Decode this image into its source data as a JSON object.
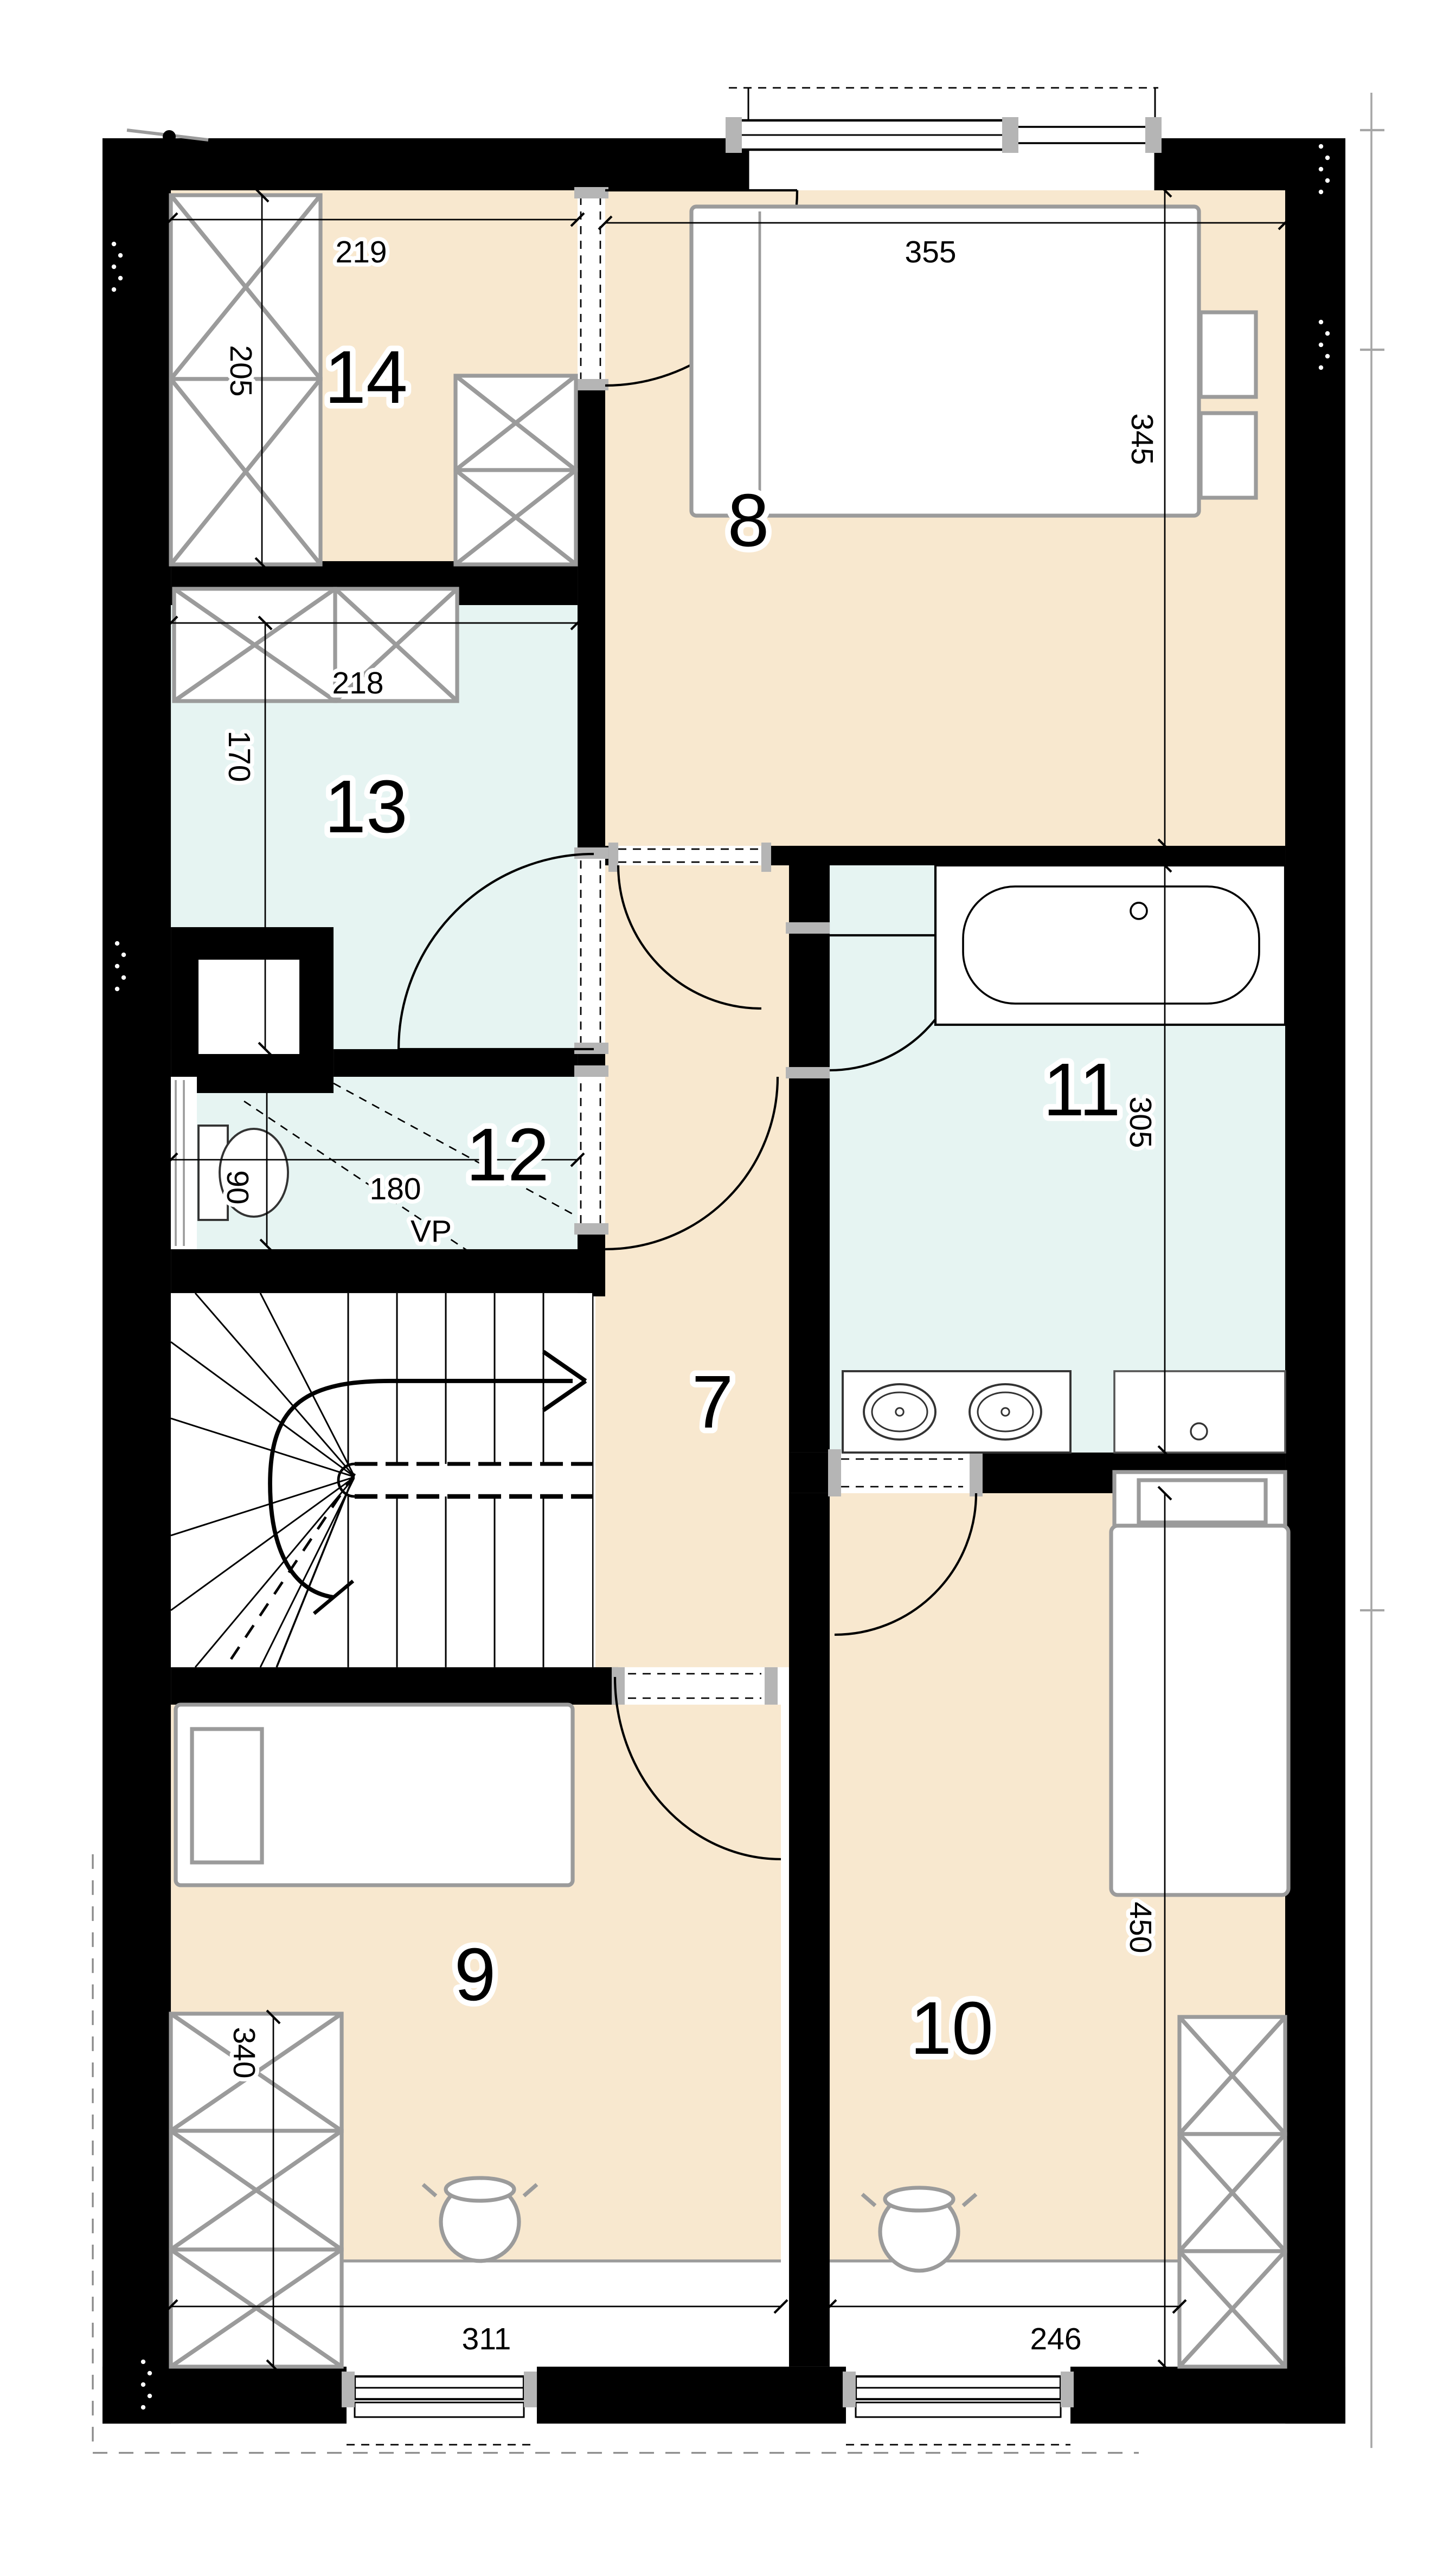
{
  "title": "Upper floor plan",
  "rooms": {
    "hall": {
      "number": "7"
    },
    "bedroom_main": {
      "number": "8"
    },
    "bedroom_left": {
      "number": "9"
    },
    "bedroom_right": {
      "number": "10"
    },
    "bathroom": {
      "number": "11"
    },
    "utility": {
      "number": "12"
    },
    "dressing": {
      "number": "13"
    },
    "bedroom_top": {
      "number": "14"
    }
  },
  "dimensions": {
    "room14_width": "219",
    "room14_wardrobe": "205",
    "room8_width": "355",
    "room8_depth": "345",
    "room13_width": "218",
    "room13_depth": "170",
    "room12_width": "180",
    "room12_toilet": "90",
    "room11_depth": "305",
    "room10_depth": "450",
    "room10_width": "246",
    "room9_width": "311",
    "room9_wardrobe": "340"
  },
  "labels": {
    "vp": "VP"
  },
  "colors": {
    "wall": "#000000",
    "room": "#f8e8cf",
    "wet": "#e6f4f2",
    "furn": "#9b9b9b"
  }
}
